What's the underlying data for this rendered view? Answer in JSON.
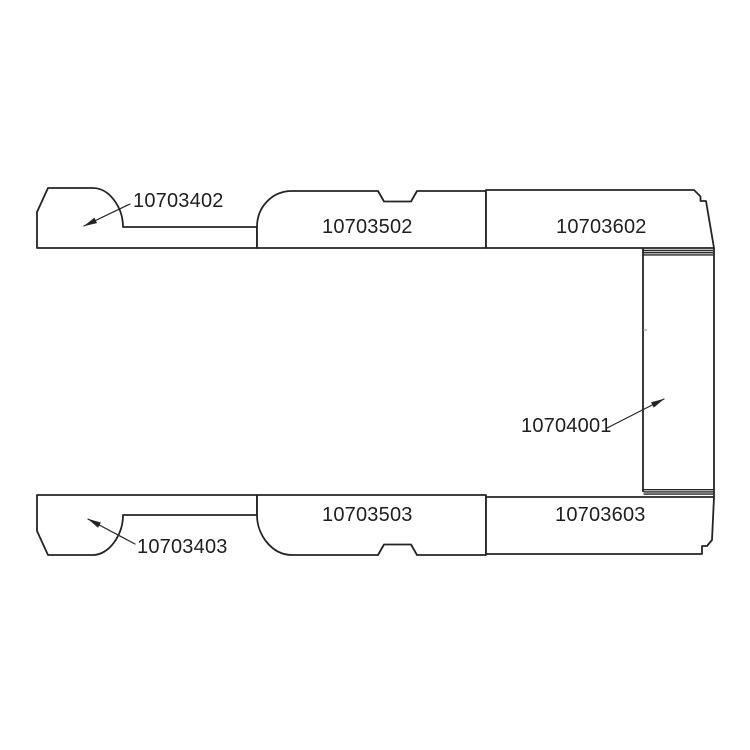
{
  "diagram": {
    "kind": "technical-parts-diagram",
    "background_color": "#ffffff",
    "line_color": "#242424",
    "text_color": "#1e1e1e",
    "parts": [
      {
        "number": "10703402"
      },
      {
        "number": "10703502"
      },
      {
        "number": "10703602"
      },
      {
        "number": "10704001"
      },
      {
        "number": "10703403"
      },
      {
        "number": "10703503"
      },
      {
        "number": "10703603"
      }
    ]
  }
}
